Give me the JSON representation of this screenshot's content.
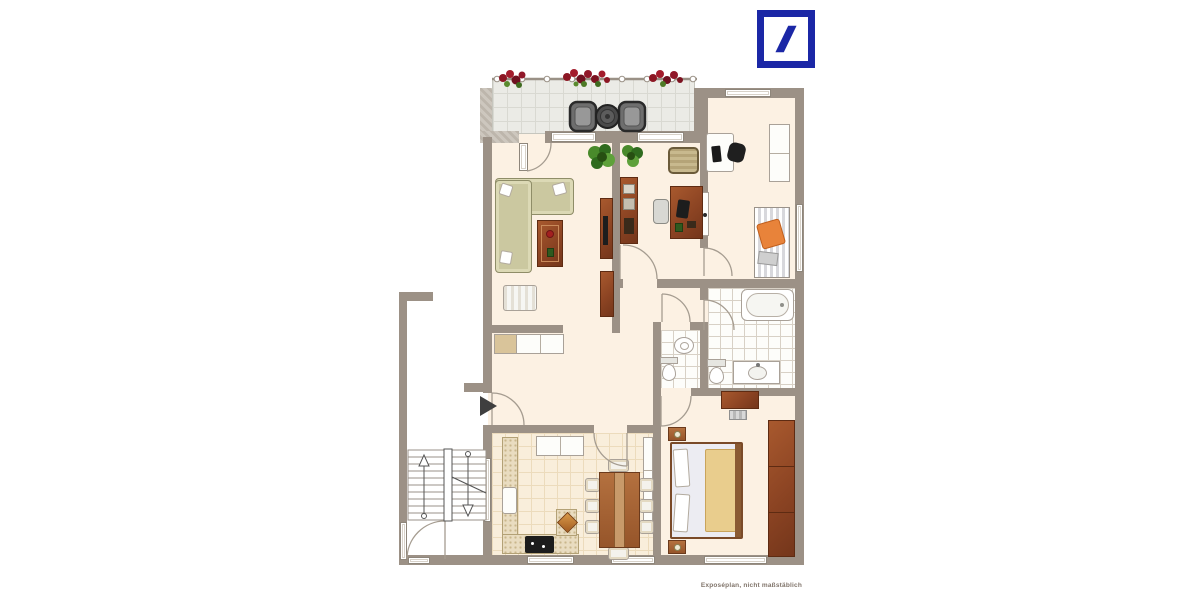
{
  "brand": {
    "name": "Deutsche Bank",
    "logo": "deutsche-bank-slash-logo",
    "logo_color": "#1B27A6"
  },
  "footer": {
    "caption": "Exposéplan, nicht maßstäblich"
  },
  "palette": {
    "background": "#ffffff",
    "wall": "#9c9186",
    "wall_light": "#c9c2b8",
    "room_floor": "#fcf1e3",
    "kitchen_floor": "#f9eedb",
    "balcony_floor": "#ebebe6",
    "bath_floor": "#fdfdfa",
    "wood_furniture": "#8c4423",
    "sofa_green": "#cbc8a0",
    "flower_red": "#8c1724",
    "plant_green": "#4e7a26",
    "blanket_orange": "#e8833a",
    "bed_blanket_tan": "#e9cd8d"
  },
  "plan": {
    "type": "apartment-floor-plan",
    "rooms": [
      {
        "name": "balcony",
        "furniture": [
          "railing",
          "flower-box",
          "flower-box",
          "flower-box",
          "patio-chair",
          "patio-table",
          "patio-chair"
        ]
      },
      {
        "name": "living-room",
        "furniture": [
          "corner-sofa",
          "cushions",
          "coffee-table",
          "armchair",
          "tv-lowboard",
          "sideboard",
          "plant"
        ]
      },
      {
        "name": "study",
        "furniture": [
          "bookshelf",
          "plant",
          "armchair",
          "desk",
          "desk-chair"
        ]
      },
      {
        "name": "childrens-room",
        "furniture": [
          "desk",
          "office-chair",
          "wardrobe",
          "single-bed",
          "blanket",
          "pillow"
        ]
      },
      {
        "name": "bathroom",
        "furniture": [
          "bathtub",
          "vanity-sink",
          "toilet"
        ]
      },
      {
        "name": "wc",
        "furniture": [
          "washbasin",
          "toilet"
        ]
      },
      {
        "name": "bedroom",
        "furniture": [
          "dresser",
          "stool",
          "nightstand",
          "double-bed",
          "nightstand",
          "wardrobe"
        ]
      },
      {
        "name": "kitchen-dining",
        "furniture": [
          "wall-cabinets",
          "kitchen-counter",
          "fridge",
          "stove",
          "decor-tile",
          "tall-unit",
          "dining-table",
          "chairs-x8"
        ]
      },
      {
        "name": "hallway",
        "furniture": [
          "sideboard",
          "entrance-arrow"
        ]
      },
      {
        "name": "stairwell",
        "furniture": [
          "staircase",
          "entrance-door"
        ]
      }
    ]
  }
}
